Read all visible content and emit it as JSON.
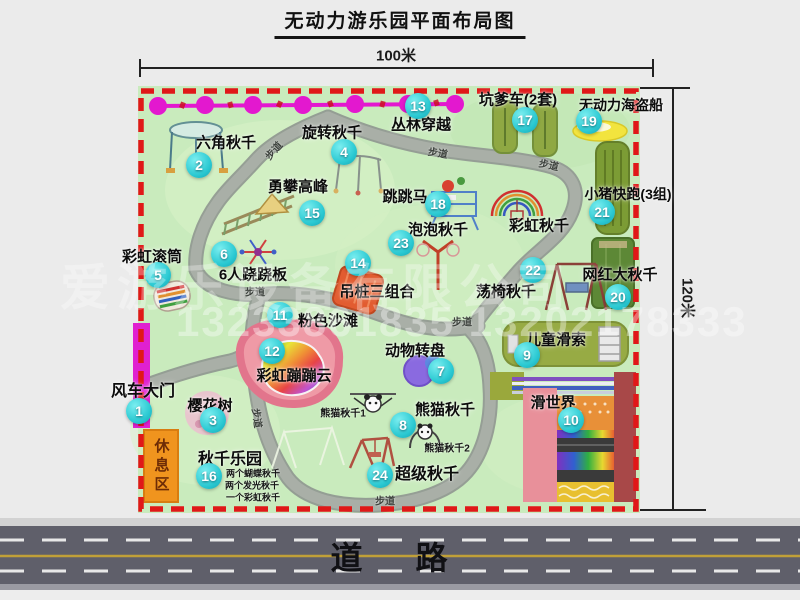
{
  "title": "无动力游乐园平面布局图",
  "scale": {
    "top": "100米",
    "right": "120米"
  },
  "road": {
    "label": "道 路"
  },
  "watermark": {
    "line1": "爱游乐设备有限公司",
    "line2": "13233861835 13202178333"
  },
  "colors": {
    "map_green": "#c9ebbd",
    "border_dash_red": "#e01818",
    "path_gray": "#a9afa7",
    "badge_cyan": "#2bc9d2",
    "garland_magenta": "#e318cf",
    "gate_magenta": "#e020d0",
    "rest_area_orange": "#f0941e",
    "road_gray": "#5f5f6a",
    "beach_pink": "#ef9aa6",
    "pirate_ship_yellow": "#f2e43e",
    "track_olive": "#8fa843"
  },
  "map": {
    "rest_area": "休息区",
    "walkway_label": "步道",
    "walkway_signs": [
      {
        "x": 273,
        "y": 150,
        "rot": -48
      },
      {
        "x": 438,
        "y": 152,
        "rot": 10
      },
      {
        "x": 549,
        "y": 164,
        "rot": 12
      },
      {
        "x": 255,
        "y": 291,
        "rot": 0
      },
      {
        "x": 462,
        "y": 321,
        "rot": 0
      },
      {
        "x": 385,
        "y": 500,
        "rot": 0
      },
      {
        "x": 258,
        "y": 418,
        "rot": 82
      }
    ],
    "attractions": [
      {
        "num": "1",
        "name": "风车大门",
        "label": {
          "x": 143,
          "y": 389,
          "fs": 16
        },
        "badge": {
          "x": 139,
          "y": 411
        }
      },
      {
        "num": "2",
        "name": "六角秋千",
        "label": {
          "x": 226,
          "y": 142,
          "fs": 15
        },
        "badge": {
          "x": 199,
          "y": 165
        }
      },
      {
        "num": "3",
        "name": "樱花树",
        "label": {
          "x": 210,
          "y": 405,
          "fs": 15
        },
        "badge": {
          "x": 213,
          "y": 420
        }
      },
      {
        "num": "4",
        "name": "旋转秋千",
        "label": {
          "x": 332,
          "y": 132,
          "fs": 15
        },
        "badge": {
          "x": 344,
          "y": 152
        }
      },
      {
        "num": "5",
        "name": "彩虹滚筒",
        "label": {
          "x": 152,
          "y": 256,
          "fs": 15
        },
        "badge": {
          "x": 158,
          "y": 275
        }
      },
      {
        "num": "6",
        "name": "6人跷跷板",
        "label": {
          "x": 253,
          "y": 274,
          "fs": 15
        },
        "badge": {
          "x": 224,
          "y": 254
        }
      },
      {
        "num": "7",
        "name": "动物转盘",
        "label": {
          "x": 415,
          "y": 350,
          "fs": 15
        },
        "badge": {
          "x": 441,
          "y": 371
        }
      },
      {
        "num": "8",
        "name": "熊猫秋千",
        "label": {
          "x": 445,
          "y": 409,
          "fs": 15
        },
        "badge": {
          "x": 403,
          "y": 425
        }
      },
      {
        "num": "9",
        "name": "儿童滑索",
        "label": {
          "x": 556,
          "y": 339,
          "fs": 15
        },
        "badge": {
          "x": 527,
          "y": 355
        }
      },
      {
        "num": "10",
        "name": "滑世界",
        "label": {
          "x": 553,
          "y": 402,
          "fs": 15
        },
        "badge": {
          "x": 571,
          "y": 420
        }
      },
      {
        "num": "11",
        "name": "粉色沙滩",
        "label": {
          "x": 328,
          "y": 320,
          "fs": 15
        },
        "badge": {
          "x": 280,
          "y": 315
        }
      },
      {
        "num": "12",
        "name": "彩虹蹦蹦云",
        "label": {
          "x": 294,
          "y": 375,
          "fs": 15
        },
        "badge": {
          "x": 272,
          "y": 351
        }
      },
      {
        "num": "13",
        "name": "丛林穿越",
        "label": {
          "x": 421,
          "y": 124,
          "fs": 15
        },
        "badge": {
          "x": 418,
          "y": 106
        }
      },
      {
        "num": "14",
        "name": "吊桩三组合",
        "label": {
          "x": 377,
          "y": 291,
          "fs": 15
        },
        "badge": {
          "x": 358,
          "y": 263
        }
      },
      {
        "num": "15",
        "name": "勇攀高峰",
        "label": {
          "x": 298,
          "y": 186,
          "fs": 15
        },
        "badge": {
          "x": 312,
          "y": 213
        }
      },
      {
        "num": "16",
        "name": "秋千乐园",
        "label": {
          "x": 230,
          "y": 457,
          "fs": 16
        },
        "badge": {
          "x": 209,
          "y": 476
        }
      },
      {
        "num": "17",
        "name": "坑爹车(2套)",
        "label": {
          "x": 518,
          "y": 99,
          "fs": 15
        },
        "badge": {
          "x": 525,
          "y": 120
        }
      },
      {
        "num": "18",
        "name": "跳跳马",
        "label": {
          "x": 405,
          "y": 196,
          "fs": 15
        },
        "badge": {
          "x": 438,
          "y": 204
        }
      },
      {
        "num": "19",
        "name": "无动力海盗船",
        "label": {
          "x": 621,
          "y": 105,
          "fs": 14
        },
        "badge": {
          "x": 589,
          "y": 121
        }
      },
      {
        "num": "20",
        "name": "网红大秋千",
        "label": {
          "x": 620,
          "y": 274,
          "fs": 15
        },
        "badge": {
          "x": 618,
          "y": 297
        }
      },
      {
        "num": "21",
        "name": "小猪快跑(3组)",
        "label": {
          "x": 628,
          "y": 194,
          "fs": 14
        },
        "badge": {
          "x": 602,
          "y": 212
        }
      },
      {
        "num": "22",
        "name": "荡椅秋千",
        "label": {
          "x": 506,
          "y": 291,
          "fs": 15
        },
        "badge": {
          "x": 533,
          "y": 270
        }
      },
      {
        "num": "23",
        "name": "泡泡秋千",
        "label": {
          "x": 438,
          "y": 229,
          "fs": 15
        },
        "badge": {
          "x": 401,
          "y": 243
        }
      },
      {
        "num": "24",
        "name": "超级秋千",
        "label": {
          "x": 427,
          "y": 472,
          "fs": 16
        },
        "badge": {
          "x": 380,
          "y": 475
        }
      },
      {
        "num": null,
        "name": "彩虹秋千",
        "label": {
          "x": 539,
          "y": 225,
          "fs": 15
        },
        "badge": null
      }
    ],
    "sub_labels": [
      {
        "text": "熊猫秋千1",
        "x": 343,
        "y": 412,
        "fs": 10
      },
      {
        "text": "熊猫秋千2",
        "x": 447,
        "y": 447,
        "fs": 10
      },
      {
        "text": "两个蝴蝶秋千",
        "x": 253,
        "y": 473,
        "fs": 9
      },
      {
        "text": "两个发光秋千",
        "x": 252,
        "y": 485,
        "fs": 9
      },
      {
        "text": "一个彩虹秋千",
        "x": 253,
        "y": 497,
        "fs": 9
      }
    ]
  }
}
